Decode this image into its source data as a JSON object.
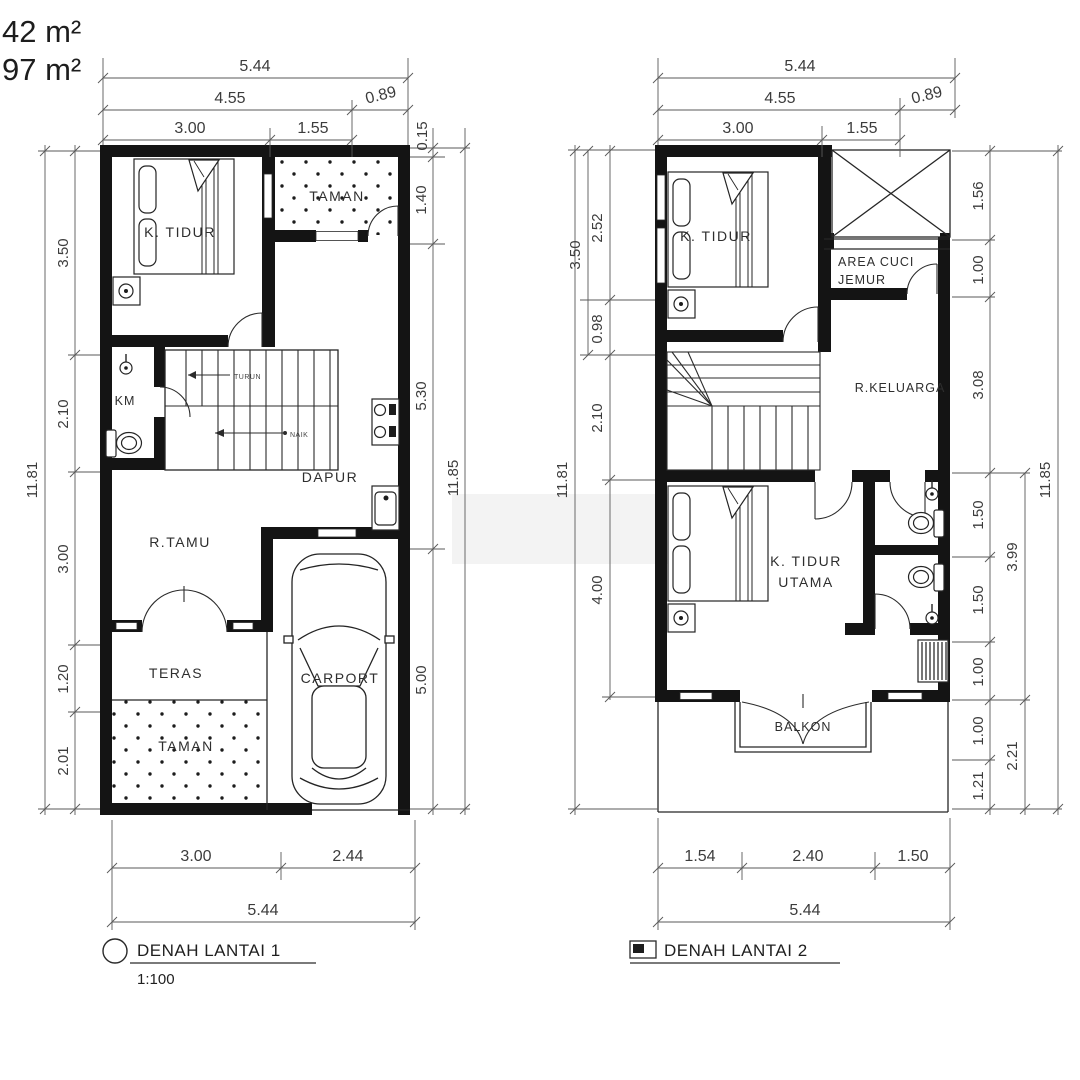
{
  "header": {
    "area_top": "42 m²",
    "area_bottom": "97 m²"
  },
  "colors": {
    "wall": "#141414",
    "line": "#262626",
    "dim_text": "#3c3c3c",
    "paper": "#ffffff"
  },
  "plan1": {
    "title": "DENAH LANTAI 1",
    "scale": "1:100",
    "rooms": {
      "bedroom": "K. TIDUR",
      "garden_top": "TAMAN",
      "bath": "KM",
      "kitchen": "DAPUR",
      "living": "R.TAMU",
      "terrace": "TERAS",
      "garden_bottom": "TAMAN",
      "carport": "CARPORT"
    },
    "stairs": {
      "down": "TURUN",
      "up": "NAIK"
    },
    "dims": {
      "top": [
        "5.44",
        "4.55",
        "0.89",
        "3.00",
        "1.55",
        "0.15"
      ],
      "left": {
        "outer": "11.81",
        "chain": [
          "3.50",
          "2.10",
          "3.00",
          "1.20",
          "2.01"
        ]
      },
      "right": {
        "chain": [
          "1.40",
          "5.30",
          "5.00"
        ],
        "outer": "11.85"
      },
      "bottom": [
        "3.00",
        "2.44",
        "5.44"
      ]
    }
  },
  "plan2": {
    "title": "DENAH LANTAI 2",
    "rooms": {
      "bedroom": "K. TIDUR",
      "laundry_line1": "AREA CUCI",
      "laundry_line2": "JEMUR",
      "family": "R.KELUARGA",
      "master_line1": "K. TIDUR",
      "master_line2": "UTAMA",
      "balcony": "BALKON"
    },
    "dims": {
      "top": [
        "5.44",
        "4.55",
        "0.89",
        "3.00",
        "1.55"
      ],
      "left": {
        "outer": "11.81",
        "mid": "3.50",
        "chain": [
          "2.52",
          "0.98",
          "2.10",
          "4.00"
        ]
      },
      "right": {
        "chain": [
          "1.56",
          "1.00",
          "3.08",
          "1.50",
          "1.50",
          "1.00",
          "1.00",
          "1.21"
        ],
        "mid": [
          "3.99",
          "2.21"
        ],
        "outer": "11.85"
      },
      "bottom": [
        "1.54",
        "2.40",
        "1.50",
        "5.44"
      ]
    }
  }
}
